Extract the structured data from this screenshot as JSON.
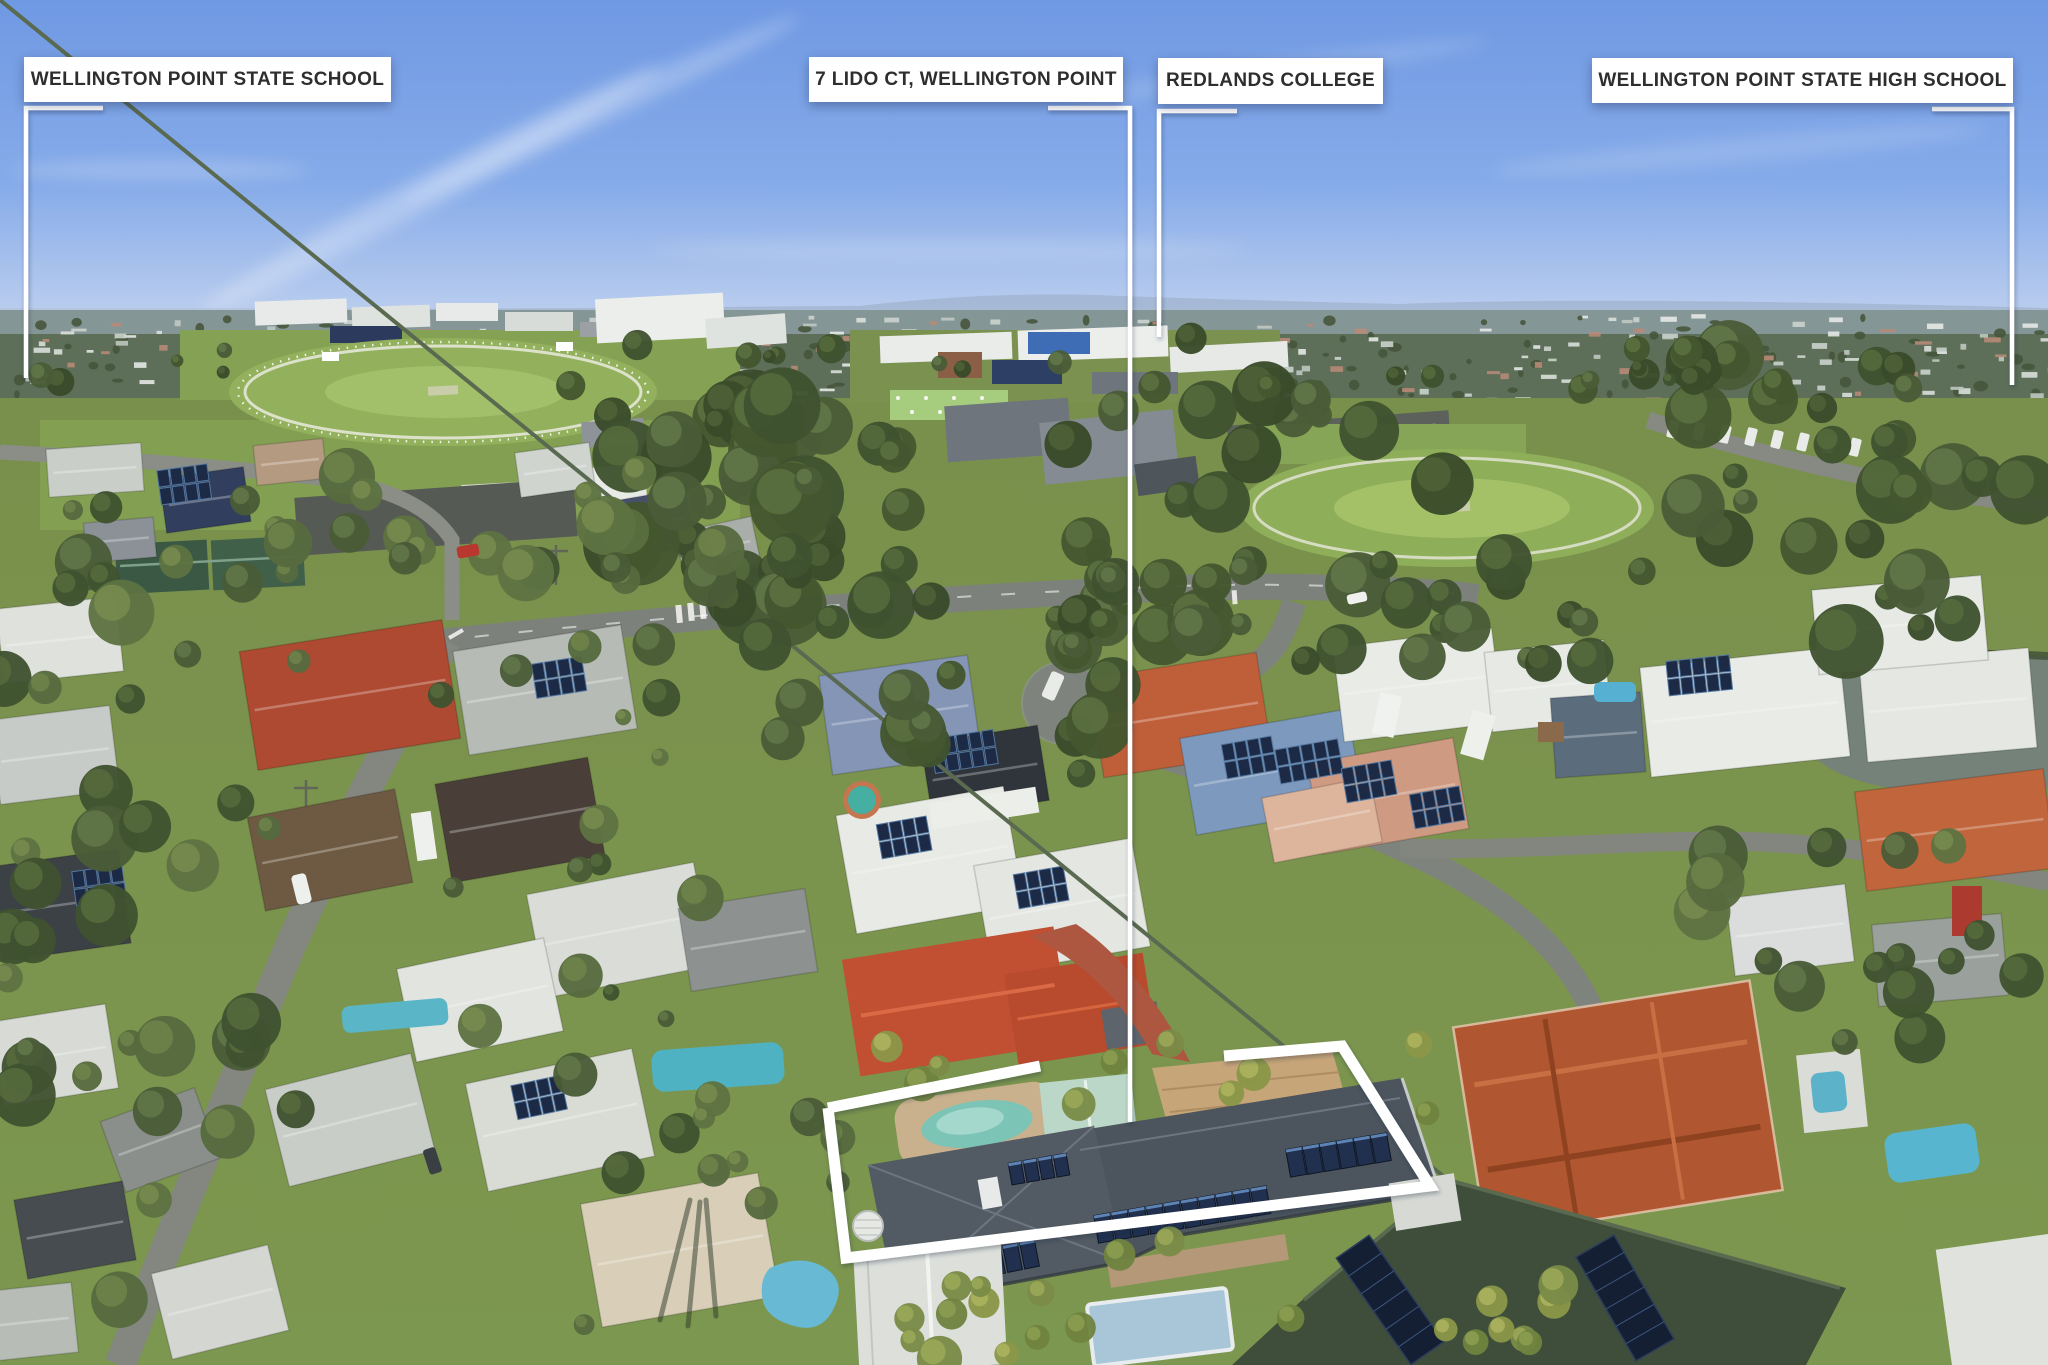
{
  "photo": {
    "description": "aerial-suburb-photo",
    "highlighted_property": "7 LIDO CT, WELLINGTON POINT"
  },
  "labels": [
    {
      "id": "wellington-point-state-school",
      "text": "WELLINGTON POINT STATE SCHOOL"
    },
    {
      "id": "property-address",
      "text": "7 LIDO CT, WELLINGTON POINT"
    },
    {
      "id": "redlands-college",
      "text": "REDLANDS COLLEGE"
    },
    {
      "id": "wellington-point-state-high-school",
      "text": "WELLINGTON POINT STATE HIGH SCHOOL"
    }
  ],
  "colors": {
    "label_background": "#ffffff",
    "label_text": "#2e2e2e",
    "leader_line": "#ffffff",
    "property_outline": "#ffffff"
  }
}
